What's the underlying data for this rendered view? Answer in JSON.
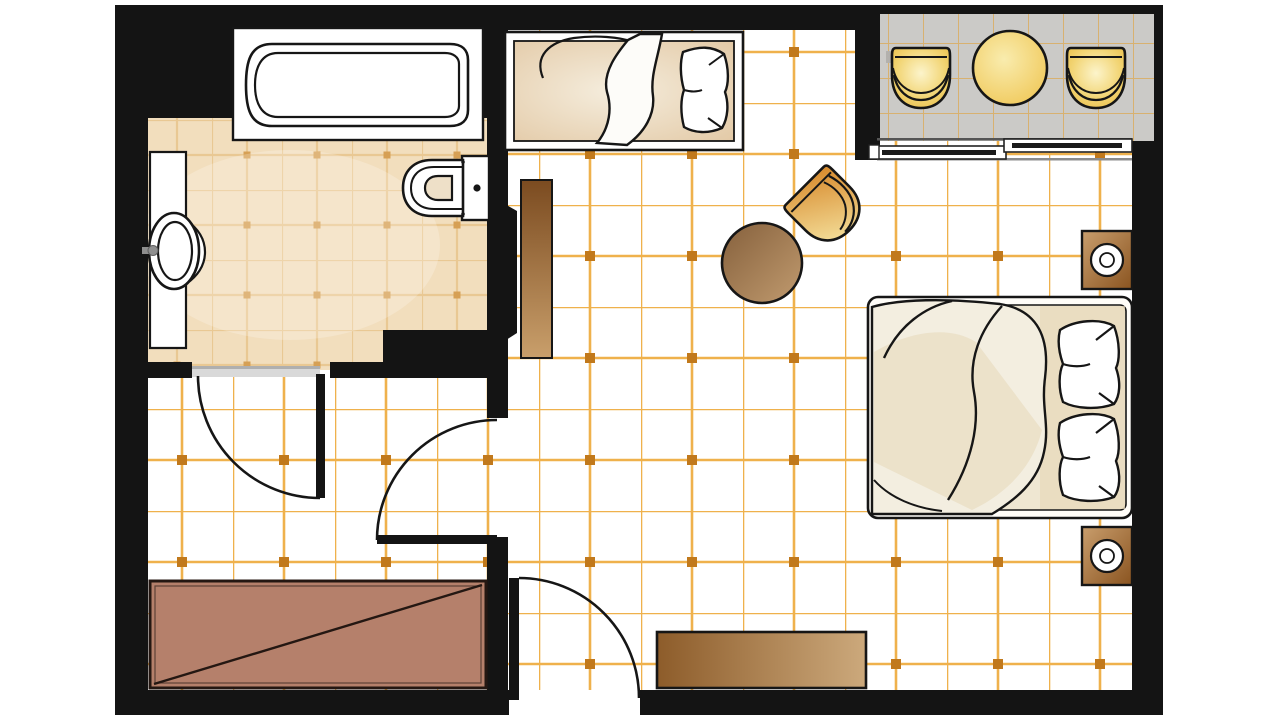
{
  "meta": {
    "type": "architectural-floor-plan",
    "description": "Top-down floor plan of a hotel guest room with bathroom, dressing area, bedroom with single and double beds, and furnished balcony",
    "visible_text": []
  },
  "palette": {
    "wall": "#141414",
    "outline": "#161616",
    "floor_main": "#FFFFFF",
    "grid_line": "#EFB14C",
    "grid_dot": "#C1791C",
    "floor_bath": "#F2DEBD",
    "bath_grid_line": "#E9C893",
    "bath_grid_dot": "#D6A055",
    "floor_balcony": "#CBCAC7",
    "balcony_grid_line": "#D8B170",
    "fixture_white": "#FFFFFF",
    "threshold_gray": "#D9D9D9",
    "gold_light": "#FCF4CB",
    "gold_dark": "#E8B93E",
    "wood_light": "#C99F6B",
    "wood_dark": "#7B4B20",
    "terracotta": "#B5806B",
    "duvet_cream": "#F3EEE0",
    "duvet_shade": "#E6D5B3",
    "mattress_cream": "#EFE7D2"
  },
  "rooms": [
    {
      "id": "bathroom",
      "label": "bathroom"
    },
    {
      "id": "dressing-area",
      "label": "dressing area"
    },
    {
      "id": "bedroom",
      "label": "bedroom"
    },
    {
      "id": "balcony",
      "label": "balcony"
    }
  ],
  "furniture": [
    {
      "room": "bathroom",
      "item": "bathtub"
    },
    {
      "room": "bathroom",
      "item": "vanity with washbasin and faucet"
    },
    {
      "room": "bathroom",
      "item": "toilet with cistern"
    },
    {
      "room": "bathroom",
      "item": "swing door with arc"
    },
    {
      "room": "bedroom",
      "item": "single bed with pillow and folded duvet"
    },
    {
      "room": "bedroom",
      "item": "tall wardrobe cabinet"
    },
    {
      "room": "bedroom",
      "item": "open door leaf"
    },
    {
      "room": "bedroom",
      "item": "tub armchair"
    },
    {
      "room": "bedroom",
      "item": "round side table"
    },
    {
      "room": "bedroom",
      "item": "double bed with duvet and two pillows"
    },
    {
      "room": "bedroom",
      "item": "nightstand with lamp (upper)"
    },
    {
      "room": "bedroom",
      "item": "nightstand with lamp (lower)"
    },
    {
      "room": "bedroom",
      "item": "low dresser console"
    },
    {
      "room": "dressing-area",
      "item": "wardrobe closet with diagonal rail symbol"
    },
    {
      "room": "dressing-area",
      "item": "swing door with arc"
    },
    {
      "room": "entry",
      "item": "entrance swing door with arc"
    },
    {
      "room": "balcony",
      "item": "sliding glass door"
    },
    {
      "room": "balcony",
      "item": "tub chair (left)"
    },
    {
      "room": "balcony",
      "item": "tub chair (right)"
    },
    {
      "room": "balcony",
      "item": "round table"
    }
  ]
}
